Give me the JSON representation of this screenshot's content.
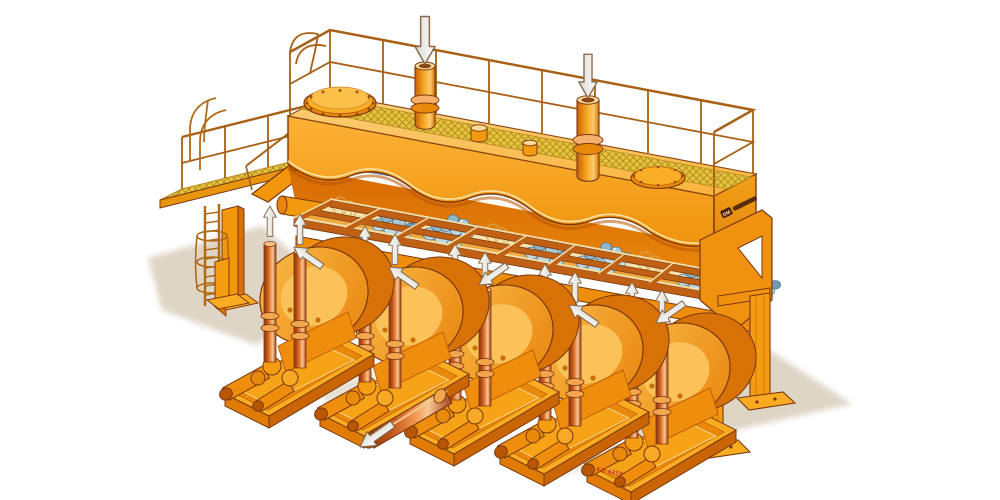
{
  "scene": {
    "description": "Isometric cutaway illustration of a five-unit piston diaphragm pump station with a top surge tank, mesh walkway, railings, access ladder platform, valve frame with ball valves, and flow arrows",
    "background_color": "#ffffff",
    "style": "orange technical cutaway artwork"
  },
  "labels": {
    "brand_box": "DM",
    "serial_marking": "KE 6958"
  },
  "palette": {
    "orange_main": "#F49D13",
    "orange_light": "#FBC457",
    "orange_deep": "#E07C06",
    "outline_brown": "#7A3810",
    "mesh_yellow": "#E3C43F",
    "valve_ball_blue": "#A9C9D8",
    "copper_column": "#C2571B",
    "ground_shadow": "#D8CEBB",
    "arrow_white": "#FFFFFF",
    "serial_red": "#C03020"
  },
  "counts": {
    "pump_units": 5,
    "vertical_damper_columns": 10,
    "inlet_pipes": 2,
    "manholes": 2,
    "valve_frame_bays": 9,
    "inlet_down_arrows": 2,
    "column_up_arrows": 10,
    "housing_flow_arrows": 5,
    "outlet_arrows": 1
  }
}
